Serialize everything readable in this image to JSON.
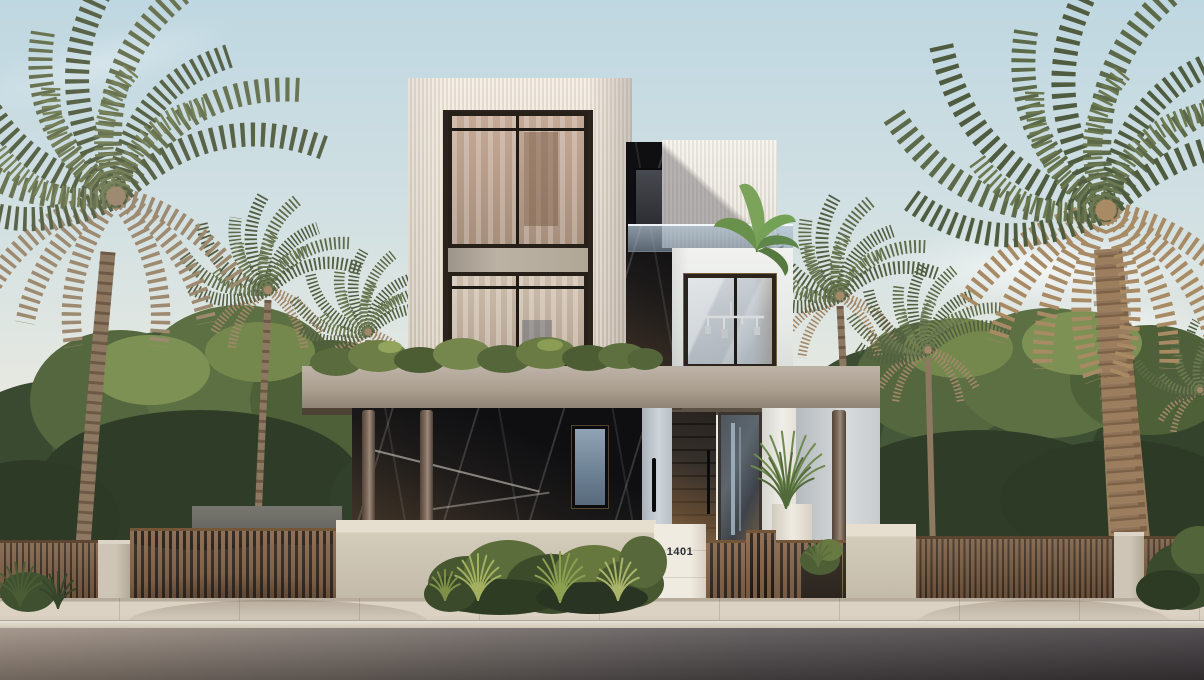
{
  "scene": {
    "type": "architectural exterior render",
    "description": "Photorealistic street view of a modern three-storey villa with fluted cream facades, a dark marble core, a glass-balustrade terrace with a banana plant, a concrete entrance canopy on round timber columns, timber slat gates and fences, date palms and dense street landscaping under a pale sky.",
    "house_number": "1401"
  },
  "palette": {
    "sky_top": "#bfd7e1",
    "sky_horizon": "#ece7dc",
    "facade_fluted_cream": "#eae2d5",
    "facade_white": "#eeefed",
    "marble_dark": "#17171b",
    "concrete_canopy": "#ab9f90",
    "timber_slats": "#7b5c41",
    "entry_door_wood": "#2b2521",
    "glass_warm_curtain": "#b89e8b",
    "glass_cool": "#9fb0bf",
    "foliage_green": "#4d5e3a",
    "palm_dry_frond": "#a3886a",
    "sidewalk_concrete": "#d5ccbe",
    "asphalt_road": "#4a4647"
  }
}
